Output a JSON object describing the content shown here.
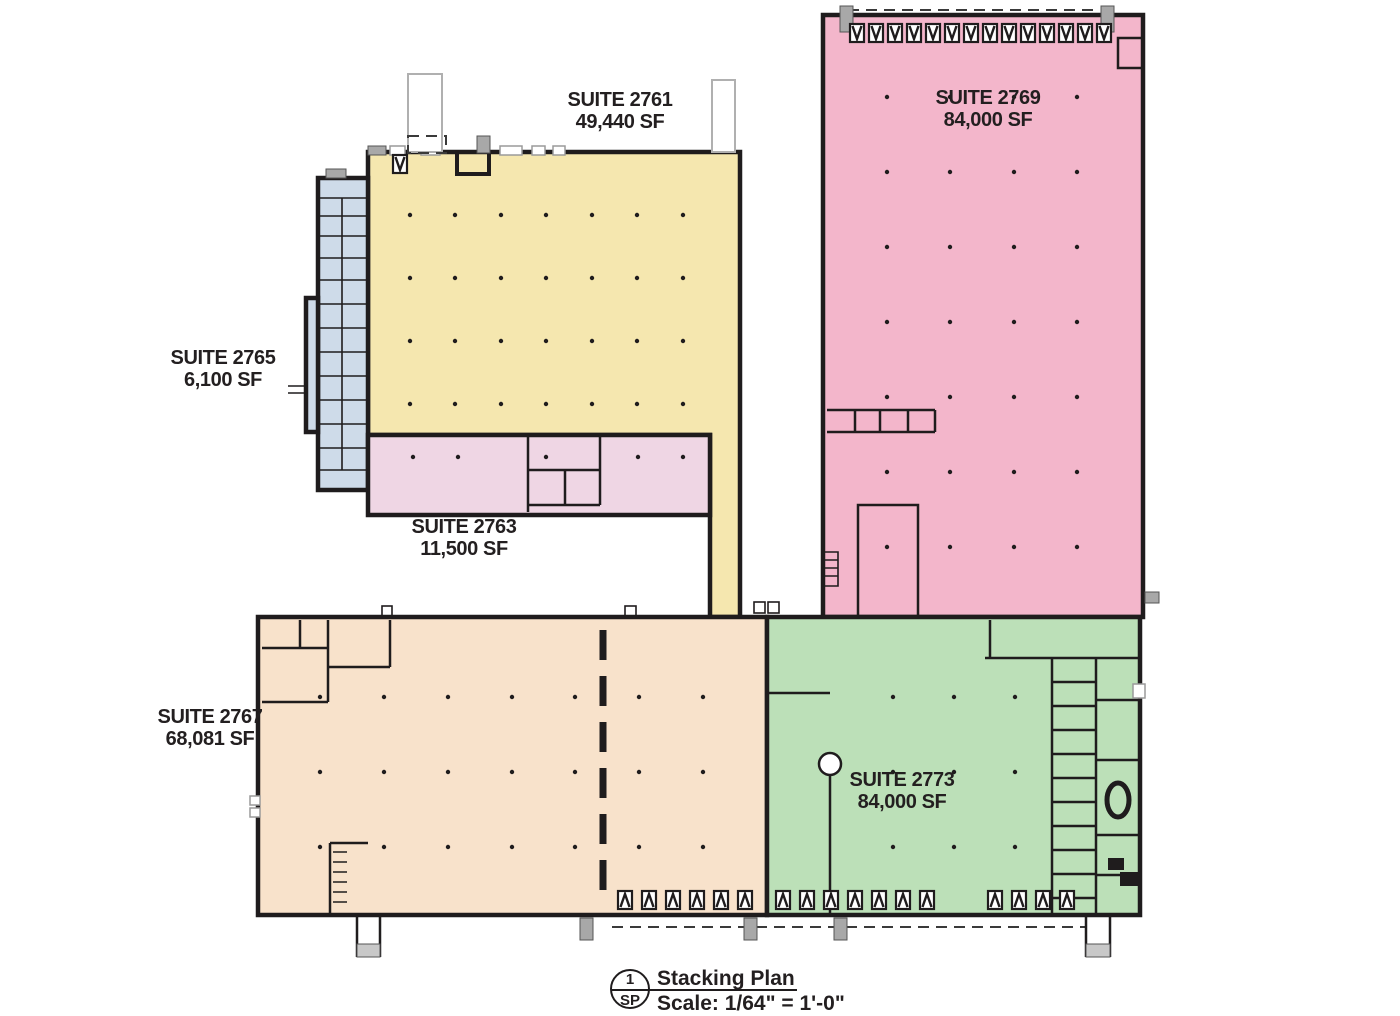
{
  "plan": {
    "suites": [
      {
        "id": "2761",
        "name": "SUITE 2761",
        "area": "49,440 SF",
        "color": "#f5e7af"
      },
      {
        "id": "2769",
        "name": "SUITE 2769",
        "area": "84,000 SF",
        "color": "#f3b6cb"
      },
      {
        "id": "2765",
        "name": "SUITE 2765",
        "area": "6,100 SF",
        "color": "#cedbe9"
      },
      {
        "id": "2763",
        "name": "SUITE 2763",
        "area": "11,500 SF",
        "color": "#efd6e4"
      },
      {
        "id": "2767",
        "name": "SUITE 2767",
        "area": "68,081 SF",
        "color": "#f8e2cb"
      },
      {
        "id": "2773",
        "name": "SUITE 2773",
        "area": "84,000 SF",
        "color": "#bce0b8"
      }
    ],
    "title_block": {
      "detail_number": "1",
      "sheet_code": "SP",
      "title": "Stacking Plan",
      "scale": "Scale: 1/64\" = 1'-0\""
    },
    "colors": {
      "wall": "#1f1c1d",
      "text": "#231f20",
      "background": "#ffffff"
    }
  }
}
